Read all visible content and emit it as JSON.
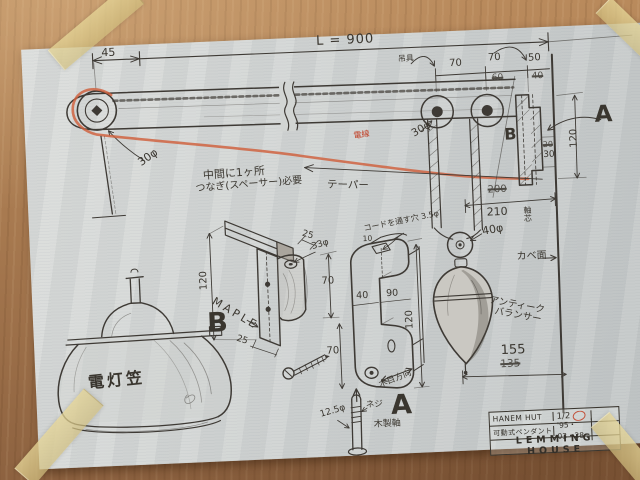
{
  "photo": {
    "labels": {
      "top": {
        "offset45": "45",
        "length": "L = 900",
        "hanger": "吊具",
        "dim70a": "70",
        "dim70b": "70",
        "dim60old": "60",
        "dim50": "50",
        "dim40old": "40"
      },
      "arm": {
        "pulleyLeft": "30φ",
        "pulleyMid": "30φ",
        "note1": "中間に1ヶ所",
        "note2": "つなぎ(スペーサー)必要",
        "taper": "テーパー",
        "wire": "電線",
        "spanOld": "200",
        "spanNew": "210"
      },
      "wall": {
        "labelA": "A",
        "labelB": "B",
        "dim120": "120",
        "stepOld": "20",
        "stepNew": "30",
        "wallFace": "カベ面",
        "axisCore": "軸芯",
        "pulley40": "40φ",
        "balancerLine1": "アンティーク",
        "balancerLine2": "バランサー",
        "dim155": "155",
        "dim135old": "135"
      },
      "partB": {
        "label": "B",
        "material": "MAPLE",
        "dim120": "120",
        "dim25top": "25",
        "dim33": "33φ",
        "dim70": "70",
        "dim25bottom": "25"
      },
      "partA": {
        "label": "A",
        "holeNote": "コードを通す穴 3.5φ",
        "dim10": "10",
        "dim40": "40",
        "dim90": "90",
        "dim120": "120",
        "dim70": "70",
        "grainDir": "木目方向",
        "screw": "ネジ",
        "woodShaft": "木製軸",
        "dim125": "12.5φ"
      },
      "lamp": {
        "caption": "電灯笠"
      }
    },
    "title_block": {
      "project": "HANEM HUT",
      "scale": "1/2",
      "drawing_title": "可動式ペンダント",
      "date": "'95・03・28",
      "studio": "LEMMING HOUSE"
    },
    "colors": {
      "pencil": "#3e3a35",
      "cord_red": "#cf5f3c",
      "paper": "#d3d6d4",
      "wood": "#a6784e",
      "tape": "#d8c98e"
    }
  }
}
